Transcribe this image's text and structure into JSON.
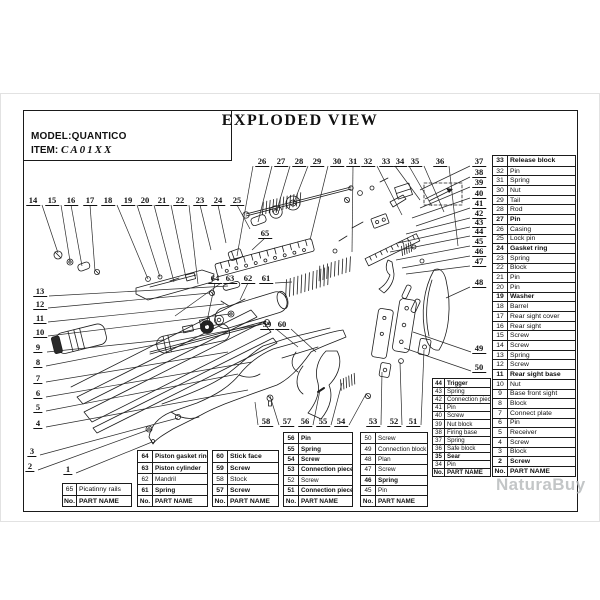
{
  "header": {
    "title": "EXPLODED VIEW",
    "model_label": "MODEL:",
    "model_value": "QUANTICO",
    "item_label": "ITEM:",
    "item_value": "CA01XX"
  },
  "watermark": {
    "text": "NaturaBuy",
    "color": "#b5b8ba"
  },
  "colors": {
    "line": "#1c1c1c",
    "frame": "#1a1a1a",
    "table_border": "#1b1b1b",
    "watermark": "#b5b8ba"
  },
  "table_header": {
    "no": "No.",
    "name": "PART NAME"
  },
  "parts_tables": [
    {
      "id": "right-parts-table",
      "x": 492,
      "y": 155,
      "w": 84,
      "rh": 9.7,
      "fs": 6.8,
      "nw": 15,
      "rows": [
        {
          "no": "33",
          "name": "Release block",
          "bold": true
        },
        {
          "no": "32",
          "name": "Pin",
          "bold": false
        },
        {
          "no": "31",
          "name": "Spring",
          "bold": false
        },
        {
          "no": "30",
          "name": "Nut",
          "bold": false
        },
        {
          "no": "29",
          "name": "Tail",
          "bold": false
        },
        {
          "no": "28",
          "name": "Rod",
          "bold": false
        },
        {
          "no": "27",
          "name": "Pin",
          "bold": true
        },
        {
          "no": "26",
          "name": "Casing",
          "bold": false
        },
        {
          "no": "25",
          "name": "Lock pin",
          "bold": false
        },
        {
          "no": "24",
          "name": "Gasket ring",
          "bold": true
        },
        {
          "no": "23",
          "name": "Spring",
          "bold": false
        },
        {
          "no": "22",
          "name": "Block",
          "bold": false
        },
        {
          "no": "21",
          "name": "Pin",
          "bold": false
        },
        {
          "no": "20",
          "name": "Pin",
          "bold": false
        },
        {
          "no": "19",
          "name": "Washer",
          "bold": true
        },
        {
          "no": "18",
          "name": "Barrel",
          "bold": false
        },
        {
          "no": "17",
          "name": "Rear sight cover",
          "bold": false
        },
        {
          "no": "16",
          "name": "Rear sight",
          "bold": false
        },
        {
          "no": "15",
          "name": "Screw",
          "bold": false
        },
        {
          "no": "14",
          "name": "Screw",
          "bold": false
        },
        {
          "no": "13",
          "name": "Spring",
          "bold": false
        },
        {
          "no": "12",
          "name": "Screw",
          "bold": false
        },
        {
          "no": "11",
          "name": "Rear sight base",
          "bold": true
        },
        {
          "no": "10",
          "name": "Nut",
          "bold": false
        },
        {
          "no": "9",
          "name": "Base front sight",
          "bold": false
        },
        {
          "no": "8",
          "name": "Block",
          "bold": false
        },
        {
          "no": "7",
          "name": "Connect plate",
          "bold": false
        },
        {
          "no": "6",
          "name": "Pin",
          "bold": false
        },
        {
          "no": "5",
          "name": "Receiver",
          "bold": false
        },
        {
          "no": "4",
          "name": "Screw",
          "bold": false
        },
        {
          "no": "3",
          "name": "Block",
          "bold": false
        },
        {
          "no": "2",
          "name": "Screw",
          "bold": true
        }
      ]
    },
    {
      "id": "right-parts-table-2",
      "x": 432,
      "y": 378,
      "w": 59,
      "rh": 8.1,
      "fs": 6.1,
      "nw": 12,
      "rows": [
        {
          "no": "44",
          "name": "Trigger",
          "bold": true
        },
        {
          "no": "43",
          "name": "Spring",
          "bold": false
        },
        {
          "no": "42",
          "name": "Connection piece",
          "bold": false
        },
        {
          "no": "41",
          "name": "Pin",
          "bold": false
        },
        {
          "no": "40",
          "name": "Screw",
          "bold": false
        },
        {
          "no": "39",
          "name": "Nut block",
          "bold": false
        },
        {
          "no": "38",
          "name": "Firing base",
          "bold": false
        },
        {
          "no": "37",
          "name": "Spring",
          "bold": false
        },
        {
          "no": "36",
          "name": "Safe block",
          "bold": false
        },
        {
          "no": "35",
          "name": "Sear",
          "bold": true
        },
        {
          "no": "34",
          "name": "Pin",
          "bold": false
        }
      ]
    },
    {
      "id": "bottom-table-65",
      "x": 62,
      "y": 483,
      "w": 70,
      "rh": 11,
      "fs": 6.8,
      "nw": 14,
      "rows": [
        {
          "no": "65",
          "name": "Picatinny rails",
          "bold": false
        }
      ]
    },
    {
      "id": "bottom-table-64",
      "x": 137,
      "y": 450,
      "w": 71,
      "rh": 11,
      "fs": 6.4,
      "nw": 15,
      "rows": [
        {
          "no": "64",
          "name": "Piston gasket ring",
          "bold": true
        },
        {
          "no": "63",
          "name": "Piston cylinder",
          "bold": true
        },
        {
          "no": "62",
          "name": "Mandril",
          "bold": false
        },
        {
          "no": "61",
          "name": "Spring",
          "bold": true
        }
      ]
    },
    {
      "id": "bottom-table-60",
      "x": 212,
      "y": 450,
      "w": 67,
      "rh": 11,
      "fs": 6.8,
      "nw": 15,
      "rows": [
        {
          "no": "60",
          "name": "Stick face",
          "bold": true
        },
        {
          "no": "59",
          "name": "Screw",
          "bold": true
        },
        {
          "no": "58",
          "name": "Stock",
          "bold": false
        },
        {
          "no": "57",
          "name": "Screw",
          "bold": true
        }
      ]
    },
    {
      "id": "bottom-table-56",
      "x": 283,
      "y": 432,
      "w": 70,
      "rh": 10.4,
      "fs": 6.3,
      "nw": 15,
      "rows": [
        {
          "no": "56",
          "name": "Pin",
          "bold": true
        },
        {
          "no": "55",
          "name": "Spring",
          "bold": true
        },
        {
          "no": "54",
          "name": "Screw",
          "bold": true
        },
        {
          "no": "53",
          "name": "Connection piece",
          "bold": true
        },
        {
          "no": "52",
          "name": "Screw",
          "bold": false
        },
        {
          "no": "51",
          "name": "Connection piece",
          "bold": true
        }
      ]
    },
    {
      "id": "bottom-table-50",
      "x": 360,
      "y": 432,
      "w": 68,
      "rh": 10.4,
      "fs": 6.3,
      "nw": 15,
      "rows": [
        {
          "no": "50",
          "name": "Screw",
          "bold": false
        },
        {
          "no": "49",
          "name": "Connection block",
          "bold": false
        },
        {
          "no": "48",
          "name": "Plan",
          "bold": false
        },
        {
          "no": "47",
          "name": "Screw",
          "bold": false
        },
        {
          "no": "46",
          "name": "Spring",
          "bold": true
        },
        {
          "no": "45",
          "name": "Pin",
          "bold": false
        }
      ]
    }
  ],
  "callouts": [
    {
      "n": "1",
      "x": 68,
      "y": 469,
      "tx": 152,
      "ty": 442
    },
    {
      "n": "2",
      "x": 30,
      "y": 466,
      "tx": 148,
      "ty": 430
    },
    {
      "n": "3",
      "x": 32,
      "y": 451,
      "tx": 178,
      "ty": 418
    },
    {
      "n": "4",
      "x": 38,
      "y": 423,
      "tx": 248,
      "ty": 390
    },
    {
      "n": "5",
      "x": 38,
      "y": 407,
      "tx": 238,
      "ty": 374
    },
    {
      "n": "6",
      "x": 38,
      "y": 393,
      "tx": 252,
      "ty": 362
    },
    {
      "n": "7",
      "x": 38,
      "y": 378,
      "tx": 228,
      "ty": 352
    },
    {
      "n": "8",
      "x": 38,
      "y": 362,
      "tx": 262,
      "ty": 324
    },
    {
      "n": "9",
      "x": 38,
      "y": 347,
      "tx": 163,
      "ty": 340
    },
    {
      "n": "10",
      "x": 40,
      "y": 332,
      "tx": 230,
      "ty": 314
    },
    {
      "n": "11",
      "x": 40,
      "y": 318,
      "tx": 224,
      "ty": 304
    },
    {
      "n": "12",
      "x": 40,
      "y": 304,
      "tx": 210,
      "ty": 293
    },
    {
      "n": "13",
      "x": 40,
      "y": 291,
      "tx": 228,
      "ty": 286
    },
    {
      "n": "14",
      "x": 33,
      "y": 200,
      "tx": 58,
      "ty": 253
    },
    {
      "n": "15",
      "x": 52,
      "y": 200,
      "tx": 70,
      "ty": 261
    },
    {
      "n": "16",
      "x": 71,
      "y": 200,
      "tx": 82,
      "ty": 266
    },
    {
      "n": "17",
      "x": 90,
      "y": 200,
      "tx": 95,
      "ty": 271
    },
    {
      "n": "18",
      "x": 108,
      "y": 200,
      "tx": 148,
      "ty": 279
    },
    {
      "n": "19",
      "x": 128,
      "y": 200,
      "tx": 160,
      "ty": 277
    },
    {
      "n": "20",
      "x": 145,
      "y": 200,
      "tx": 174,
      "ty": 282
    },
    {
      "n": "21",
      "x": 162,
      "y": 200,
      "tx": 186,
      "ty": 278
    },
    {
      "n": "22",
      "x": 180,
      "y": 200,
      "tx": 198,
      "ty": 284
    },
    {
      "n": "23",
      "x": 200,
      "y": 200,
      "tx": 211,
      "ty": 250
    },
    {
      "n": "24",
      "x": 218,
      "y": 200,
      "tx": 226,
      "ty": 243
    },
    {
      "n": "25",
      "x": 237,
      "y": 200,
      "tx": 250,
      "ty": 229
    },
    {
      "n": "26",
      "x": 262,
      "y": 161,
      "tx": 237,
      "ty": 256
    },
    {
      "n": "27",
      "x": 281,
      "y": 161,
      "tx": 258,
      "ty": 222
    },
    {
      "n": "28",
      "x": 299,
      "y": 161,
      "tx": 276,
      "ty": 213
    },
    {
      "n": "29",
      "x": 317,
      "y": 161,
      "tx": 293,
      "ty": 205
    },
    {
      "n": "30",
      "x": 337,
      "y": 161,
      "tx": 310,
      "ty": 240
    },
    {
      "n": "31",
      "x": 353,
      "y": 161,
      "tx": 352,
      "ty": 252
    },
    {
      "n": "32",
      "x": 368,
      "y": 161,
      "tx": 402,
      "ty": 215
    },
    {
      "n": "33",
      "x": 386,
      "y": 161,
      "tx": 420,
      "ty": 200
    },
    {
      "n": "34",
      "x": 400,
      "y": 161,
      "tx": 432,
      "ty": 206
    },
    {
      "n": "35",
      "x": 415,
      "y": 161,
      "tx": 444,
      "ty": 212
    },
    {
      "n": "36",
      "x": 440,
      "y": 161,
      "tx": 458,
      "ty": 246
    },
    {
      "n": "37",
      "x": 479,
      "y": 161,
      "tx": 420,
      "ty": 190
    },
    {
      "n": "38",
      "x": 479,
      "y": 172,
      "tx": 425,
      "ty": 199
    },
    {
      "n": "39",
      "x": 479,
      "y": 182,
      "tx": 420,
      "ty": 208
    },
    {
      "n": "40",
      "x": 479,
      "y": 193,
      "tx": 412,
      "ty": 218
    },
    {
      "n": "41",
      "x": 479,
      "y": 203,
      "tx": 416,
      "ty": 226
    },
    {
      "n": "42",
      "x": 479,
      "y": 213,
      "tx": 406,
      "ty": 234
    },
    {
      "n": "43",
      "x": 479,
      "y": 222,
      "tx": 398,
      "ty": 243
    },
    {
      "n": "44",
      "x": 479,
      "y": 231,
      "tx": 390,
      "ty": 252
    },
    {
      "n": "45",
      "x": 479,
      "y": 241,
      "tx": 396,
      "ty": 260
    },
    {
      "n": "46",
      "x": 479,
      "y": 251,
      "tx": 402,
      "ty": 268
    },
    {
      "n": "47",
      "x": 479,
      "y": 261,
      "tx": 406,
      "ty": 274
    },
    {
      "n": "48",
      "x": 479,
      "y": 282,
      "tx": 446,
      "ty": 298
    },
    {
      "n": "49",
      "x": 479,
      "y": 348,
      "tx": 413,
      "ty": 332
    },
    {
      "n": "50",
      "x": 479,
      "y": 367,
      "tx": 404,
      "ty": 348
    },
    {
      "n": "51",
      "x": 413,
      "y": 421,
      "tx": 424,
      "ty": 350
    },
    {
      "n": "52",
      "x": 394,
      "y": 421,
      "tx": 400,
      "ty": 362
    },
    {
      "n": "53",
      "x": 373,
      "y": 421,
      "tx": 382,
      "ty": 372
    },
    {
      "n": "54",
      "x": 341,
      "y": 421,
      "tx": 366,
      "ty": 394
    },
    {
      "n": "55",
      "x": 323,
      "y": 421,
      "tx": 342,
      "ty": 383
    },
    {
      "n": "56",
      "x": 305,
      "y": 421,
      "tx": 320,
      "ty": 390
    },
    {
      "n": "57",
      "x": 287,
      "y": 421,
      "tx": 270,
      "ty": 396
    },
    {
      "n": "58",
      "x": 266,
      "y": 421,
      "tx": 255,
      "ty": 402
    },
    {
      "n": "59",
      "x": 267,
      "y": 324,
      "tx": 298,
      "ty": 347
    },
    {
      "n": "60",
      "x": 282,
      "y": 324,
      "tx": 316,
      "ty": 352
    },
    {
      "n": "61",
      "x": 266,
      "y": 278,
      "tx": 292,
      "ty": 282
    },
    {
      "n": "62",
      "x": 248,
      "y": 278,
      "tx": 240,
      "ty": 300
    },
    {
      "n": "63",
      "x": 230,
      "y": 278,
      "tx": 175,
      "ty": 316
    },
    {
      "n": "64",
      "x": 215,
      "y": 278,
      "tx": 206,
      "ty": 326
    },
    {
      "n": "65",
      "x": 265,
      "y": 233,
      "tx": 252,
      "ty": 250
    }
  ]
}
